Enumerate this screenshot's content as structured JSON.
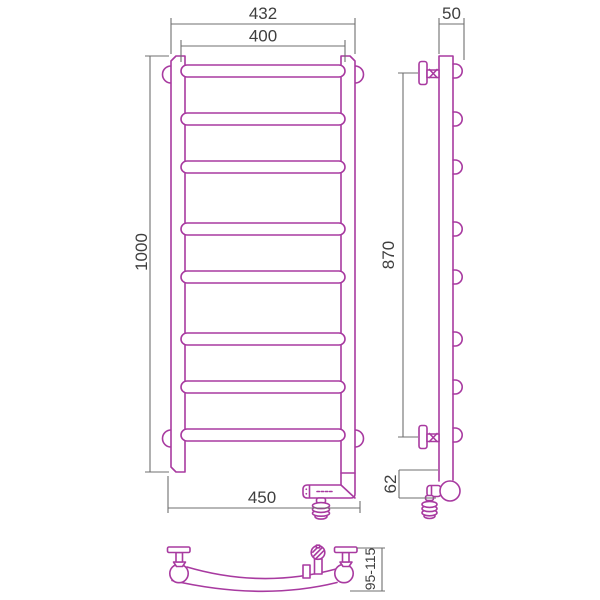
{
  "dims": {
    "front_outer_width": "432",
    "front_inner_width": "400",
    "front_height": "1000",
    "front_bottom_width": "450",
    "side_top_depth": "50",
    "side_bracket_span": "870",
    "side_bottom_offset": "62",
    "wall_clearance_range": "95-115"
  },
  "colors": {
    "outline": "#a83aa0",
    "dim": "#6f6f6f",
    "dimtext": "#3f3f3f",
    "bg": "#ffffff"
  }
}
